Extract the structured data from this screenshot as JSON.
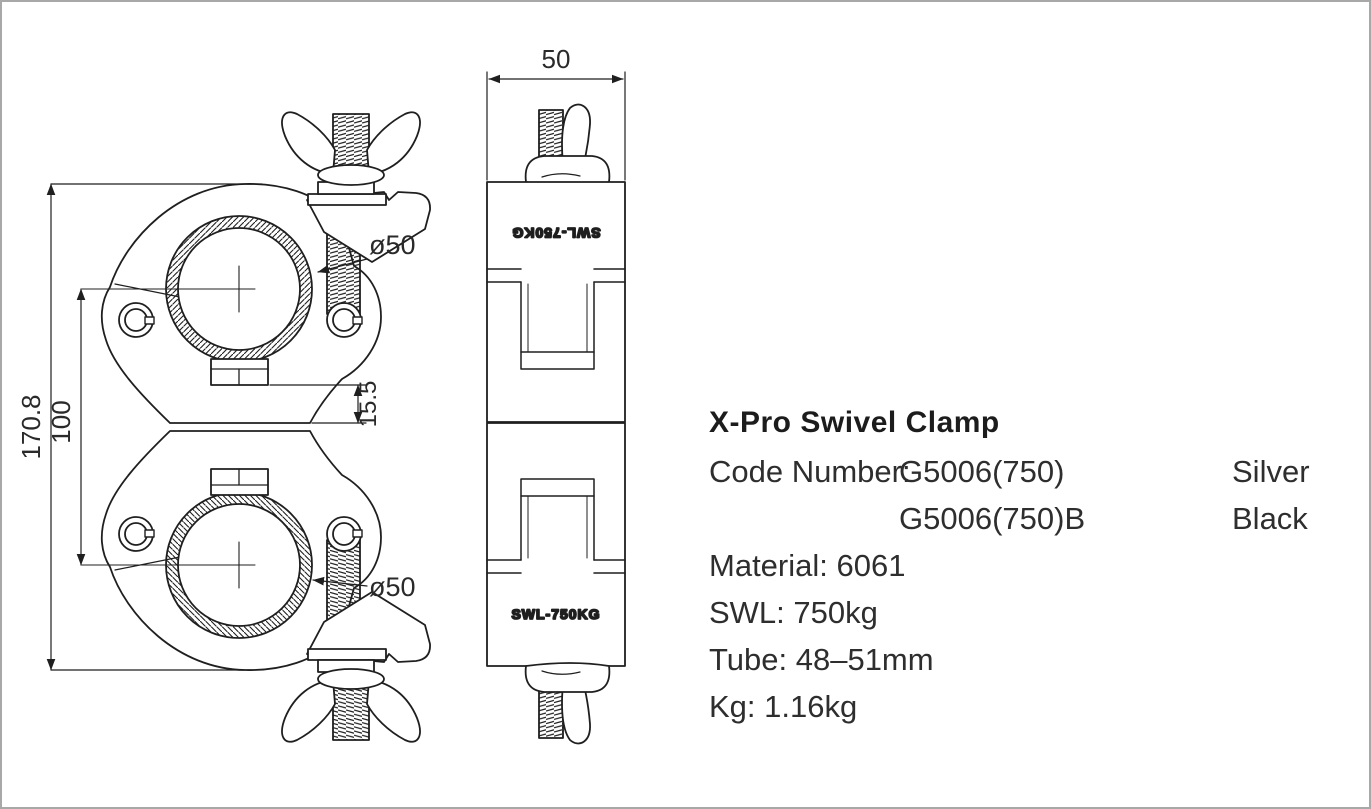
{
  "page": {
    "background": "#ffffff",
    "border_color": "#a8a8a8",
    "line_color": "#1f1f1f"
  },
  "drawing": {
    "front_view": {
      "dim_height_overall": "170.8",
      "dim_center_distance": "100",
      "dim_tube_diameter_top": "ø50",
      "dim_tube_diameter_bottom": "ø50",
      "dim_jaw_gap": "15.5"
    },
    "side_view": {
      "dim_width": "50",
      "marking_top": "SWL-750KG",
      "marking_bottom": "SWL-750KG"
    }
  },
  "specs": {
    "title": "X-Pro Swivel Clamp",
    "code_row1": {
      "label": "Code Number:",
      "code": "G5006(750)",
      "finish": "Silver"
    },
    "code_row2": {
      "code": "G5006(750)B",
      "finish": "Black"
    },
    "lines": [
      "Material: 6061",
      "SWL: 750kg",
      "Tube: 48–51mm",
      "Kg: 1.16kg"
    ]
  }
}
